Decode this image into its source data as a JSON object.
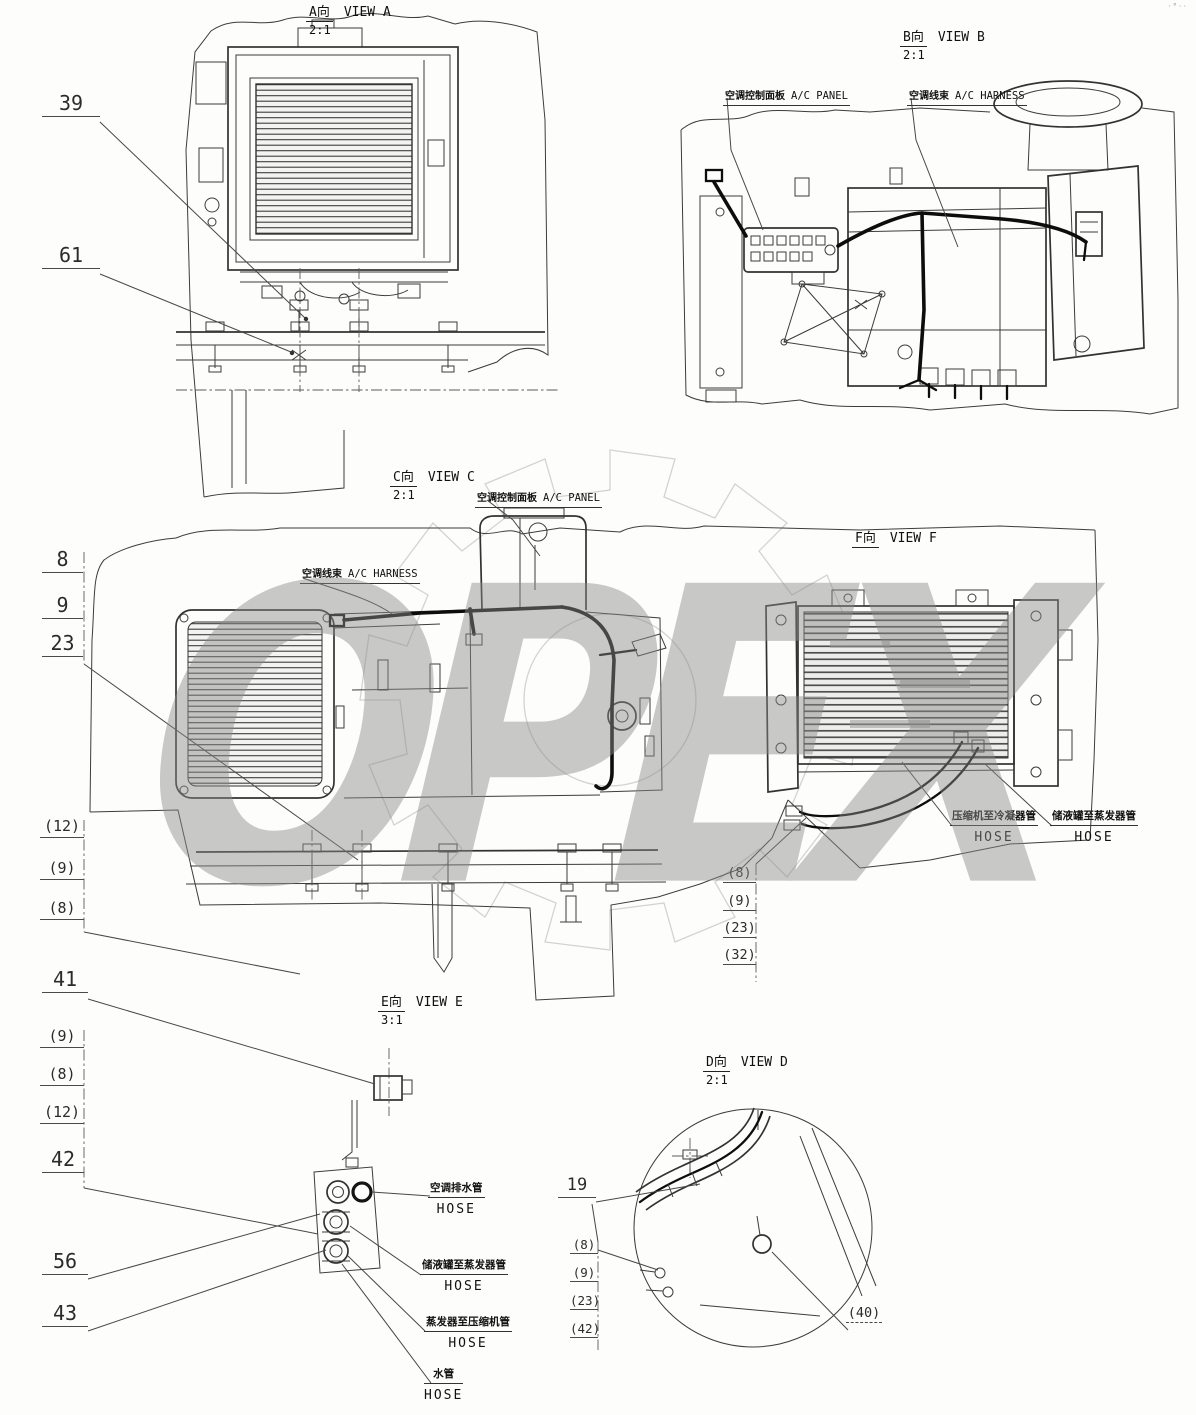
{
  "watermark": {
    "text": "OPEX"
  },
  "corner_mark": "·°··",
  "views": {
    "a": {
      "tag": "A向",
      "title": "VIEW A",
      "scale": "2:1"
    },
    "b": {
      "tag": "B向",
      "title": "VIEW B",
      "scale": "2:1"
    },
    "c": {
      "tag": "C向",
      "title": "VIEW C",
      "scale": "2:1"
    },
    "f": {
      "tag": "F向",
      "title": "VIEW F"
    },
    "e": {
      "tag": "E向",
      "title": "VIEW E",
      "scale": "3:1"
    },
    "d": {
      "tag": "D向",
      "title": "VIEW D",
      "scale": "2:1"
    }
  },
  "labels": {
    "b_panel": {
      "zh": "空调控制面板",
      "en": "A/C PANEL"
    },
    "b_harness": {
      "zh": "空调线束",
      "en": "A/C HARNESS"
    },
    "c_panel": {
      "zh": "空调控制面板",
      "en": "A/C PANEL"
    },
    "c_harness": {
      "zh": "空调线束",
      "en": "A/C HARNESS"
    }
  },
  "hoses": {
    "compressor_to_condenser": {
      "zh": "压缩机至冷凝器管",
      "en": "HOSE"
    },
    "receiver_to_evaporator_f": {
      "zh": "储液罐至蒸发器管",
      "en": "HOSE"
    },
    "ac_drain": {
      "zh": "空调排水管",
      "en": "HOSE"
    },
    "receiver_to_evaporator_e": {
      "zh": "储液罐至蒸发器管",
      "en": "HOSE"
    },
    "evaporator_to_compressor": {
      "zh": "蒸发器至压缩机管",
      "en": "HOSE"
    },
    "water": {
      "zh": "水管",
      "en": "HOSE"
    }
  },
  "callouts": {
    "view_a": [
      "39",
      "61"
    ],
    "view_c_upper": [
      "8",
      "9",
      "23"
    ],
    "view_c_lower": [
      "(12)",
      "(9)",
      "(8)"
    ],
    "view_f": [
      "(8)",
      "(9)",
      "(23)",
      "(32)"
    ],
    "view_e_top": [
      "41"
    ],
    "view_e_mid": [
      "(9)",
      "(8)",
      "(12)",
      "42"
    ],
    "view_e_low": [
      "56",
      "43"
    ],
    "view_d_top": [
      "19"
    ],
    "view_d_stack": [
      "(8)",
      "(9)",
      "(23)",
      "(42)"
    ],
    "view_d_right": [
      "(40)"
    ]
  }
}
